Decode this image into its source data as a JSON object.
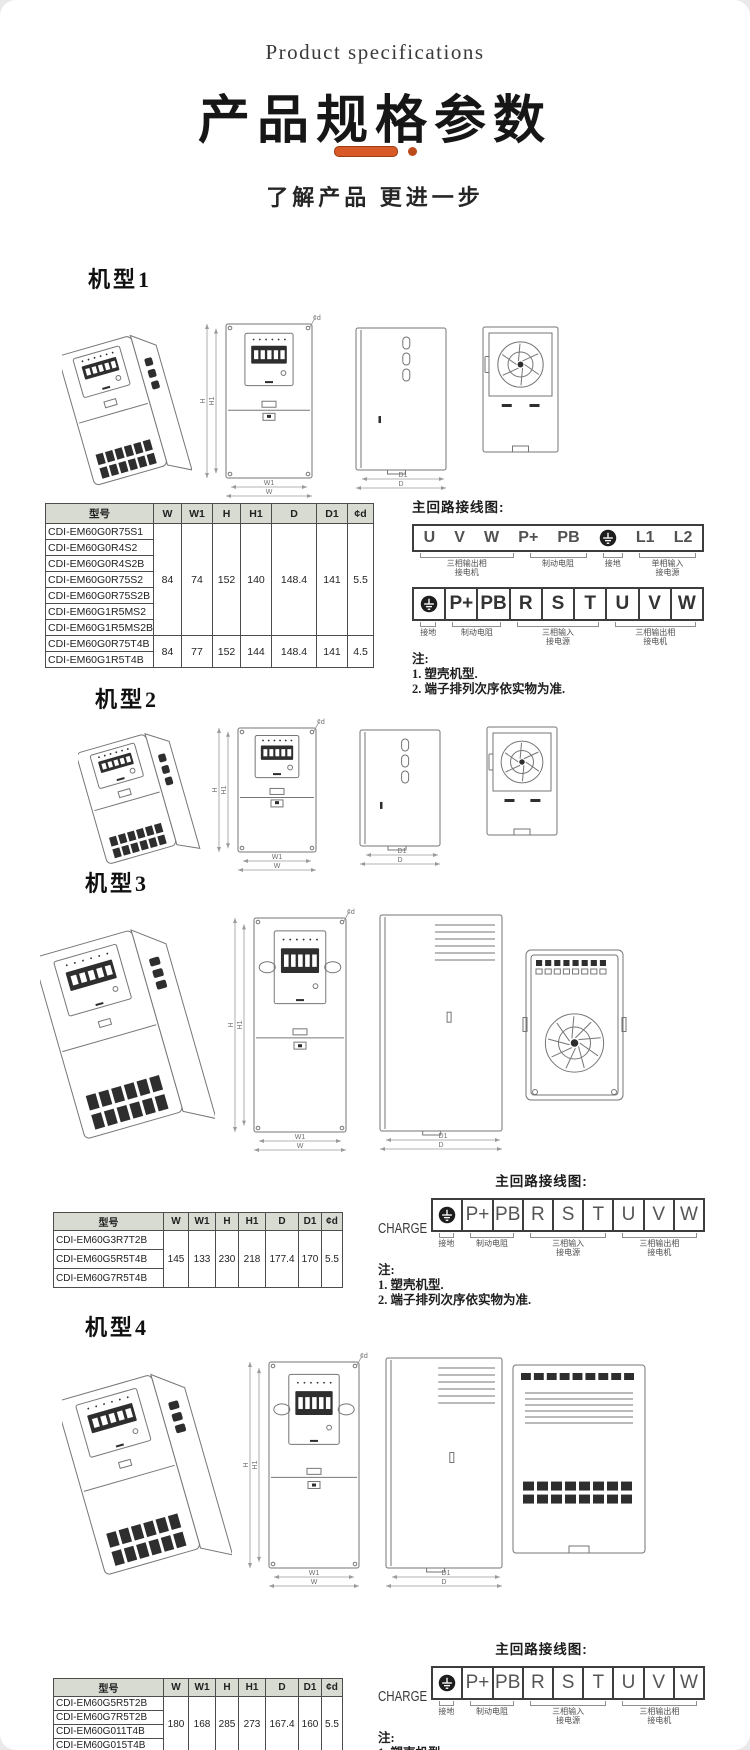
{
  "page": {
    "eyebrow": "Product specifications",
    "title": "产品规格参数",
    "subtitle": "了解产品 更进一步",
    "accent_color": "#d75a28",
    "accent_dark": "#bb4c1c"
  },
  "dims": {
    "w": "W",
    "w1": "W1",
    "h": "H",
    "h1": "H1",
    "d": "D",
    "d1": "D1",
    "phid": "¢d"
  },
  "table_headers": [
    "型号",
    "W",
    "W1",
    "H",
    "H1",
    "D",
    "D1",
    "¢d"
  ],
  "wiring_title": "主回路接线图:",
  "charge_label": "CHARGE",
  "notes": {
    "title": "注:",
    "items": [
      "1. 塑壳机型.",
      "2. 端子排列次序依实物为准."
    ]
  },
  "sections": [
    {
      "heading": "机型1",
      "table": {
        "groups": [
          {
            "models": [
              "CDI-EM60G0R75S1",
              "CDI-EM60G0R4S2",
              "CDI-EM60G0R4S2B",
              "CDI-EM60G0R75S2",
              "CDI-EM60G0R75S2B",
              "CDI-EM60G1R5MS2",
              "CDI-EM60G1R5MS2B"
            ],
            "values": [
              "84",
              "74",
              "152",
              "140",
              "148.4",
              "141",
              "5.5"
            ]
          },
          {
            "models": [
              "CDI-EM60G0R75T4B",
              "CDI-EM60G1R5T4B"
            ],
            "values": [
              "84",
              "77",
              "152",
              "144",
              "148.4",
              "141",
              "4.5"
            ]
          }
        ]
      },
      "strips": [
        {
          "style": "open",
          "charge": false,
          "cells": [
            "U",
            "V",
            "W",
            "P+",
            "PB",
            "GND",
            "L1",
            "L2"
          ],
          "labels": [
            {
              "lines": [
                "三相输出相",
                "接电机"
              ],
              "start": 0,
              "end": 2
            },
            {
              "lines": [
                "制动电阻"
              ],
              "start": 3,
              "end": 4
            },
            {
              "lines": [
                "接地"
              ],
              "start": 5,
              "end": 5
            },
            {
              "lines": [
                "单相输入",
                "接电源"
              ],
              "start": 6,
              "end": 7
            }
          ]
        },
        {
          "style": "cells",
          "charge": false,
          "cells": [
            "GND",
            "P+",
            "PB",
            "R",
            "S",
            "T",
            "U",
            "V",
            "W"
          ],
          "labels": [
            {
              "lines": [
                "接地"
              ],
              "start": 0,
              "end": 0
            },
            {
              "lines": [
                "制动电阻"
              ],
              "start": 1,
              "end": 2
            },
            {
              "lines": [
                "三相输入",
                "接电源"
              ],
              "start": 3,
              "end": 5
            },
            {
              "lines": [
                "三相输出相",
                "接电机"
              ],
              "start": 6,
              "end": 8
            }
          ]
        }
      ]
    },
    {
      "heading": "机型2"
    },
    {
      "heading": "机型3",
      "table": {
        "groups": [
          {
            "models": [
              "CDI-EM60G3R7T2B",
              "CDI-EM60G5R5T4B",
              "CDI-EM60G7R5T4B"
            ],
            "values": [
              "145",
              "133",
              "230",
              "218",
              "177.4",
              "170",
              "5.5"
            ]
          }
        ]
      },
      "strips": [
        {
          "style": "cells",
          "charge": true,
          "cells": [
            "GND",
            "P+",
            "PB",
            "R",
            "S",
            "T",
            "U",
            "V",
            "W"
          ],
          "labels": [
            {
              "lines": [
                "接地"
              ],
              "start": 0,
              "end": 0
            },
            {
              "lines": [
                "制动电阻"
              ],
              "start": 1,
              "end": 2
            },
            {
              "lines": [
                "三相输入",
                "接电源"
              ],
              "start": 3,
              "end": 5
            },
            {
              "lines": [
                "三相输出相",
                "接电机"
              ],
              "start": 6,
              "end": 8
            }
          ]
        }
      ]
    },
    {
      "heading": "机型4",
      "table": {
        "groups": [
          {
            "models": [
              "CDI-EM60G5R5T2B",
              "CDI-EM60G7R5T2B",
              "CDI-EM60G011T4B",
              "CDI-EM60G015T4B"
            ],
            "values": [
              "180",
              "168",
              "285",
              "273",
              "167.4",
              "160",
              "5.5"
            ]
          }
        ]
      },
      "strips": [
        {
          "style": "cells",
          "charge": true,
          "cells": [
            "GND",
            "P+",
            "PB",
            "R",
            "S",
            "T",
            "U",
            "V",
            "W"
          ],
          "labels": [
            {
              "lines": [
                "接地"
              ],
              "start": 0,
              "end": 0
            },
            {
              "lines": [
                "制动电阻"
              ],
              "start": 1,
              "end": 2
            },
            {
              "lines": [
                "三相输入",
                "接电源"
              ],
              "start": 3,
              "end": 5
            },
            {
              "lines": [
                "三相输出相",
                "接电机"
              ],
              "start": 6,
              "end": 8
            }
          ]
        }
      ]
    }
  ]
}
